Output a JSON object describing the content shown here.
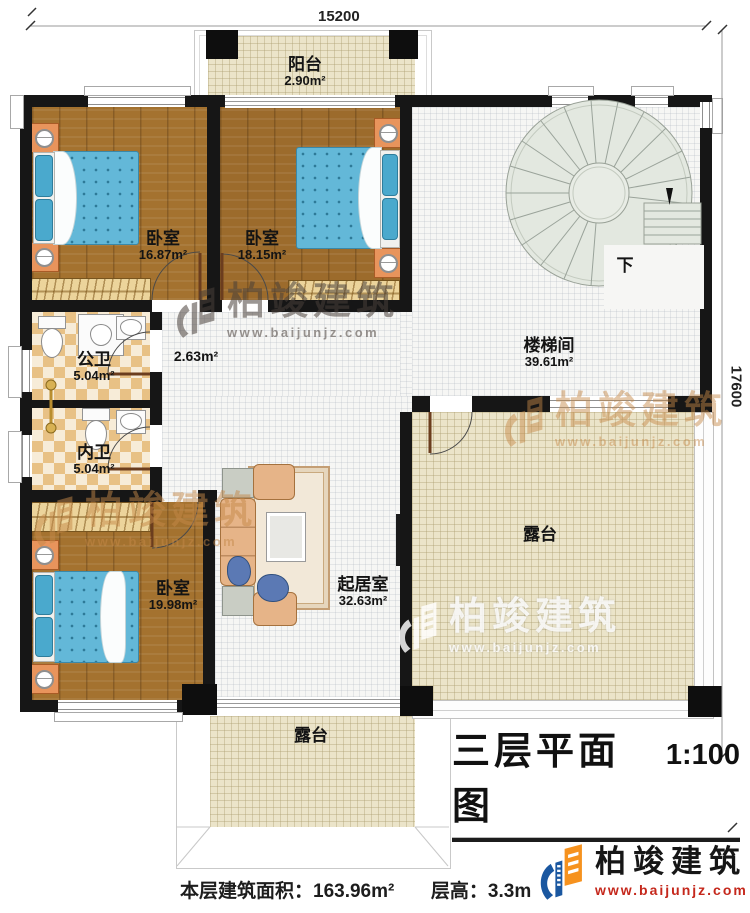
{
  "dimensions": {
    "top": "15200",
    "right": "17600"
  },
  "rooms": {
    "balcony": {
      "name": "阳台",
      "area": "2.90m²"
    },
    "bedroom1": {
      "name": "卧室",
      "area": "16.87m²"
    },
    "bedroom2": {
      "name": "卧室",
      "area": "18.15m²"
    },
    "bedroom3": {
      "name": "卧室",
      "area": "19.98m²"
    },
    "stairwell": {
      "name": "楼梯间",
      "area": "39.61m²"
    },
    "corridor": {
      "area": "2.63m²"
    },
    "public_bath": {
      "name": "公卫",
      "area": "5.04m²"
    },
    "private_bath": {
      "name": "内卫",
      "area": "5.04m²"
    },
    "living": {
      "name": "起居室",
      "area": "32.63m²"
    },
    "terrace_right": {
      "name": "露台"
    },
    "terrace_bottom": {
      "name": "露台"
    }
  },
  "stairs": {
    "down_label": "下"
  },
  "title": {
    "text": "三层平面图",
    "scale": "1:100"
  },
  "footer": {
    "floor_area": "本层建筑面积：163.96m²",
    "floor_height": "层高：3.3m"
  },
  "brand": {
    "name": "柏竣建筑",
    "url": "www.baijunjz.com"
  },
  "watermark": {
    "name": "柏竣建筑",
    "url": "www.baijunjz.com"
  },
  "colors": {
    "wall": "#161616",
    "wood_floor": "#a4722f",
    "bathroom_tile": "#e8c185",
    "terrace_floor": "#ebe4c9",
    "bed_blue": "#63b8d8",
    "brand_blue": "#1a57a0",
    "brand_orange": "#f6921e",
    "brand_red": "#c5281c"
  }
}
